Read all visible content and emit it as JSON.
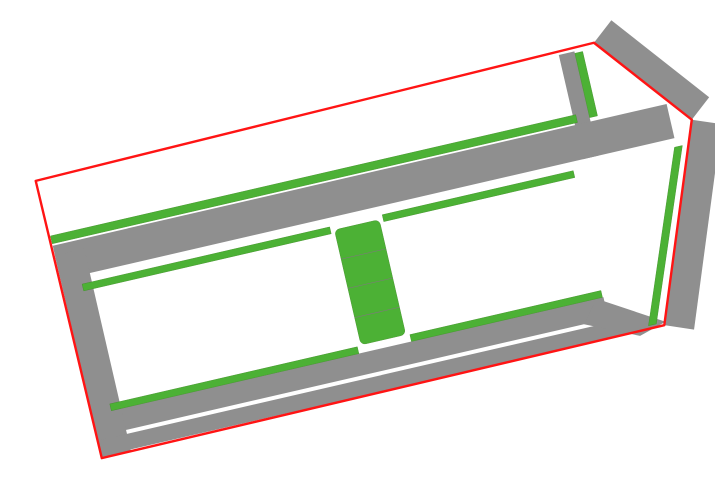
{
  "roads": {
    "n1_label": "Đường N1",
    "n2_label": "Đường N2",
    "d2_label": "Đường D2",
    "d3_label": "Đường D3",
    "highway_label": "Đi Quốc lộ 51",
    "dimension_note": "30x13"
  },
  "colors": {
    "lot_fill": "#F4AF7E",
    "lot_border": "#A24FB0",
    "road": "#8F8F8F",
    "green": "#4CB135",
    "boundary": "#FF1414",
    "highlight": "#E0017C",
    "label_text": "#15153F"
  },
  "blocks": {
    "north_row": {
      "lots": [
        {
          "id": "LK36",
          "area": "132.8"
        },
        {
          "id": "LK35",
          "area": "112.4"
        },
        {
          "id": "LK34",
          "area": "112.8"
        },
        {
          "id": "LK33",
          "area": "113.2"
        },
        {
          "id": "LK32",
          "area": "113.6"
        },
        {
          "id": "LK31",
          "area": "114.0"
        },
        {
          "id": "LK30",
          "area": "114.4"
        },
        {
          "id": "LK29",
          "area": "114.4"
        },
        {
          "id": "LK28",
          "area": "114.0"
        },
        {
          "id": "LK27",
          "area": "113.6"
        },
        {
          "id": "LK26",
          "area": "113.2"
        },
        {
          "id": "LK25",
          "area": "112.8"
        },
        {
          "id": "LK24",
          "area": "112.5"
        },
        {
          "id": "LK23",
          "area": "112.1"
        },
        {
          "id": "LK22",
          "area": "111.8"
        },
        {
          "id": "LK21",
          "area": "111.4"
        },
        {
          "id": "LK20",
          "area": "111.0"
        },
        {
          "id": "LK19",
          "area": "110.6"
        },
        {
          "id": "LK18",
          "area": "110.1"
        },
        {
          "id": "LK17",
          "area": "109.7"
        },
        {
          "id": "LK16",
          "area": "109.2"
        },
        {
          "id": "LK15",
          "area": "108.8"
        },
        {
          "id": "LK14",
          "area": "108.4"
        },
        {
          "id": "LK13",
          "area": "108.0"
        },
        {
          "id": "LK12",
          "area": "107.5"
        },
        {
          "id": "LK11",
          "area": "107.1"
        },
        {
          "id": "LK10",
          "area": "106.6"
        },
        {
          "id": "LK9",
          "area": "106.2"
        },
        {
          "id": "LK8",
          "area": "105.8"
        },
        {
          "id": "LK7",
          "area": "105.3"
        },
        {
          "id": "LK6",
          "area": "104.8"
        },
        {
          "id": "LK5",
          "area": "104.4"
        }
      ]
    },
    "northeast": {
      "lots": [
        {
          "id": "LK1",
          "area": "115.4"
        },
        {
          "id": "LK2",
          "area": "101.2"
        },
        {
          "id": "LK3",
          "area": "100.4"
        },
        {
          "id": "LK4",
          "area": "100.8"
        }
      ]
    },
    "west_top": {
      "lots": [
        {
          "id": "LK37",
          "area": "93.4"
        },
        {
          "id": "LK38",
          "area": "100.0"
        },
        {
          "id": "LK39",
          "area": "100.0"
        },
        {
          "id": "LK40",
          "area": "100.0"
        },
        {
          "id": "LK41",
          "area": "100.0"
        },
        {
          "id": "LK42",
          "area": "100.0"
        },
        {
          "id": "LK43",
          "area": "100.0"
        },
        {
          "id": "LK44",
          "area": "100.0"
        },
        {
          "id": "LK45",
          "area": "100.0"
        },
        {
          "id": "LK46",
          "area": "100.0"
        },
        {
          "id": "LK47",
          "area": "100.0"
        },
        {
          "id": "LK48",
          "area": "100.0"
        },
        {
          "id": "LK49",
          "area": "100.0"
        }
      ],
      "highlight_lot": {
        "id": "",
        "area": ""
      }
    },
    "west_bottom": {
      "lots": [
        {
          "id": "LK96",
          "area": "96.7"
        },
        {
          "id": "LK95",
          "area": "100.0"
        },
        {
          "id": "LK94",
          "area": "100.0"
        },
        {
          "id": "LK93",
          "area": "100.0"
        },
        {
          "id": "LK92",
          "area": "100.0"
        },
        {
          "id": "LK91",
          "area": "100.0"
        },
        {
          "id": "LK90",
          "area": "100.0"
        },
        {
          "id": "LK89",
          "area": "100.0"
        },
        {
          "id": "LK88",
          "area": "100.0"
        },
        {
          "id": "LK87",
          "area": "100.0"
        },
        {
          "id": "LK86",
          "area": "100.0"
        },
        {
          "id": "LK85",
          "area": "100.0"
        },
        {
          "id": "LK84",
          "area": "100.0"
        },
        {
          "id": "LK83",
          "area": "85.5"
        }
      ]
    },
    "east_top": {
      "lots": [
        {
          "id": "LK51",
          "area": "95.3"
        },
        {
          "id": "LK52",
          "area": "100.0"
        },
        {
          "id": "LK53",
          "area": "100.0"
        },
        {
          "id": "LK54",
          "area": "100.0"
        },
        {
          "id": "LK55",
          "area": "100.0"
        },
        {
          "id": "LK56",
          "area": "100.0"
        },
        {
          "id": "LK57",
          "area": "100.0"
        },
        {
          "id": "LK58",
          "area": "100.0"
        },
        {
          "id": "LK59",
          "area": "100.0"
        },
        {
          "id": "LK60",
          "area": "100.0"
        },
        {
          "id": "LK61",
          "area": "100.0"
        },
        {
          "id": "LK62",
          "area": "100.0"
        }
      ]
    },
    "east_bottom": {
      "lots": [
        {
          "id": "LK82",
          "area": "95.5"
        },
        {
          "id": "LK81",
          "area": "100.0"
        },
        {
          "id": "LK80",
          "area": "100.0"
        },
        {
          "id": "LK79",
          "area": "100.0"
        },
        {
          "id": "LK78",
          "area": "100.0"
        },
        {
          "id": "LK77",
          "area": "100.0"
        },
        {
          "id": "LK76",
          "area": "100.0"
        },
        {
          "id": "LK75",
          "area": "100.0"
        },
        {
          "id": "LK74",
          "area": "100.0"
        },
        {
          "id": "LK73",
          "area": "100.0"
        },
        {
          "id": "LK72",
          "area": "100.0"
        },
        {
          "id": "LK71",
          "area": "100.0"
        }
      ]
    },
    "east_column": {
      "lots": [
        {
          "id": "LK63",
          "area": "100.9"
        },
        {
          "id": "LK64",
          "area": "104.6"
        },
        {
          "id": "LK65",
          "area": "103.8"
        },
        {
          "id": "LK66",
          "area": "103.0"
        },
        {
          "id": "LK67",
          "area": "102.2"
        },
        {
          "id": "LK68",
          "area": "101.5"
        },
        {
          "id": "LK69",
          "area": "100.7"
        },
        {
          "id": "LK70",
          "area": "95.2"
        }
      ]
    }
  }
}
